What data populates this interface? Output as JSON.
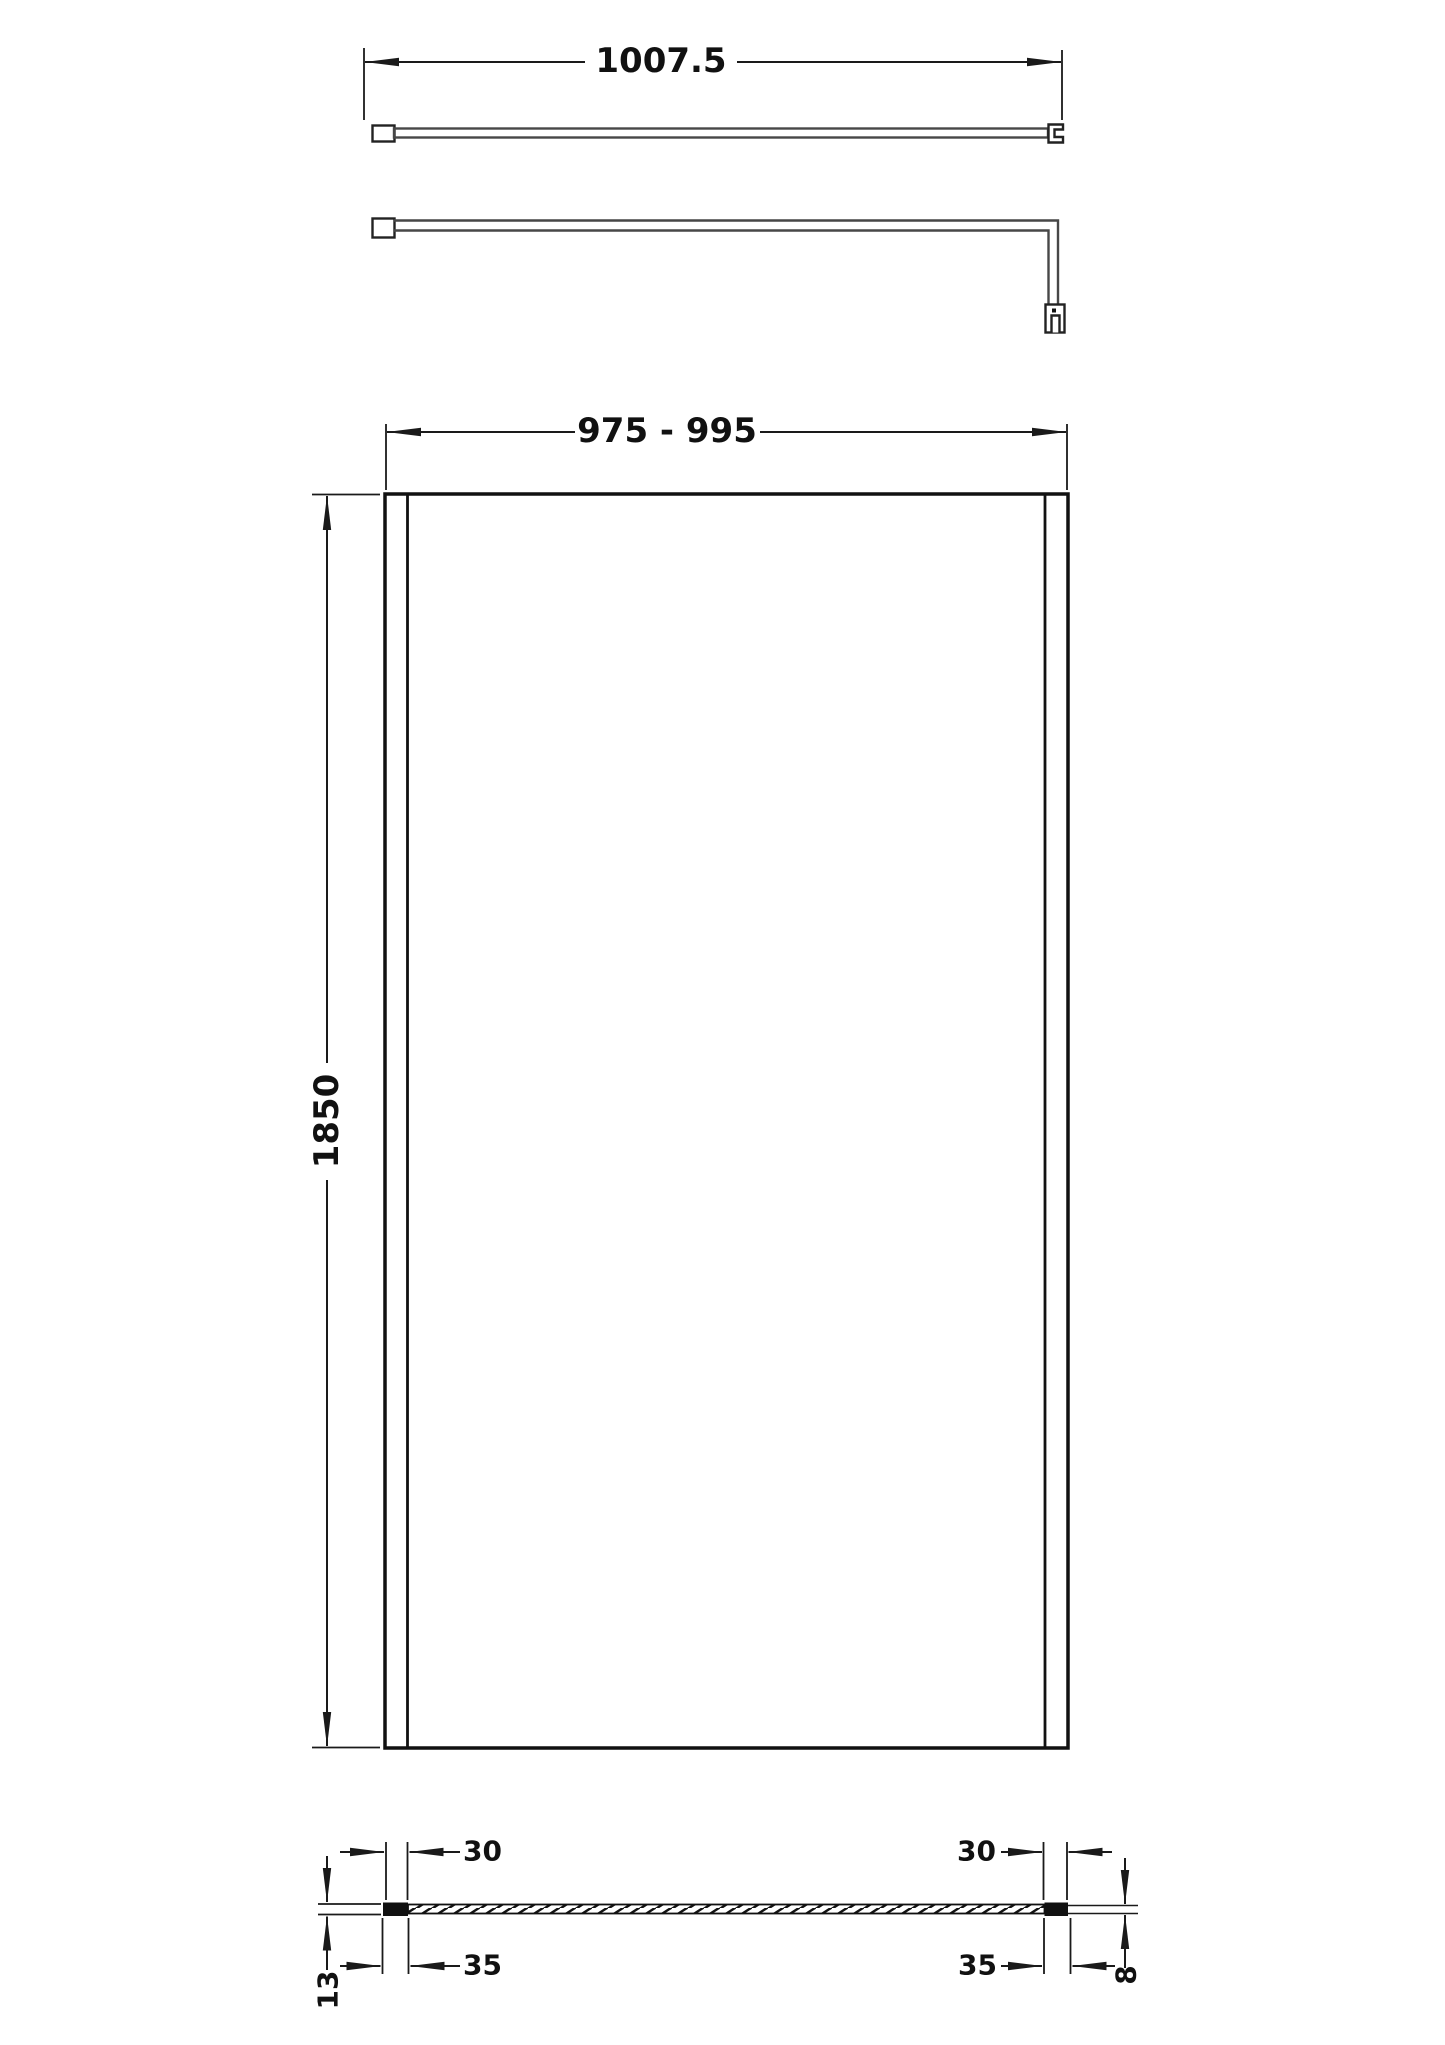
{
  "colors": {
    "line": "#1a1a1a",
    "bar_line": "#474747",
    "profile_fill": "#111111",
    "background": "#ffffff"
  },
  "bar_top_view": {
    "length_label": "1007.5"
  },
  "front_view": {
    "width_label": "975 - 995",
    "height_label": "1850"
  },
  "plan_view": {
    "left_profile_width_label": "30",
    "right_profile_width_label": "30",
    "left_overall_width_label": "35",
    "right_overall_width_label": "35",
    "profile_depth_label": "13",
    "glass_thickness_label": "8"
  }
}
